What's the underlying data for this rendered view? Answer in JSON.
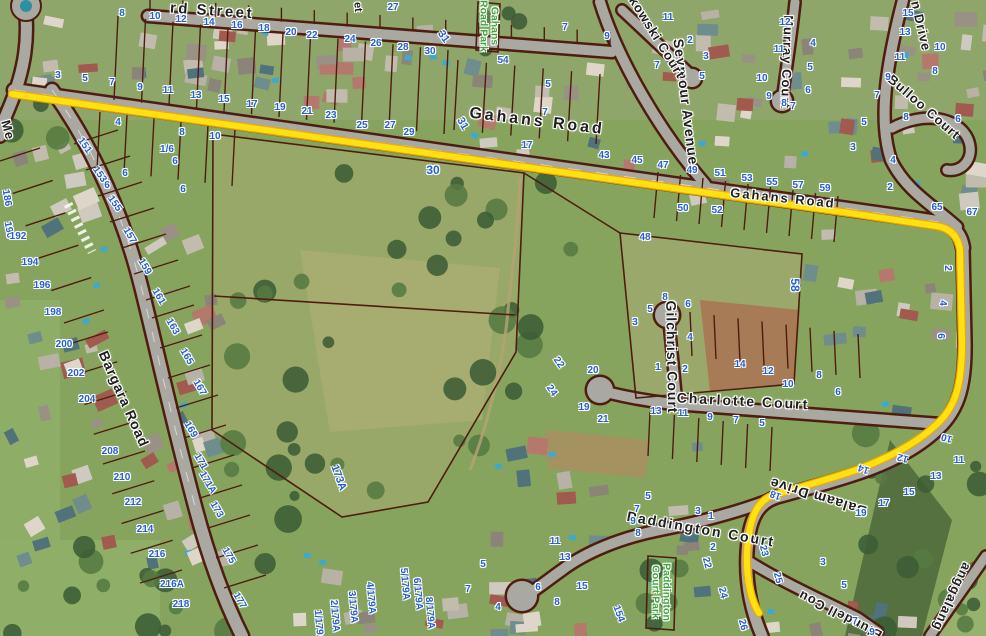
{
  "map": {
    "colors": {
      "route_highlight": "#ffe011",
      "route_highlight_edge": "#eda903",
      "cadastral_boundary": "#4f1d10",
      "lot_number_text": "#2660cf",
      "street_label_text": "#1f1f1f",
      "park_label_text": "#3ea43d",
      "road_surface": "#a9a9a1",
      "grass": "#86a45e"
    },
    "street_labels": [
      {
        "text": "rd Street",
        "x": 212,
        "y": 11,
        "rot": 4,
        "size": 15,
        "sp": 2.5
      },
      {
        "text": "Gahans Road",
        "x": 537,
        "y": 122,
        "rot": 7,
        "size": 16,
        "sp": 3
      },
      {
        "text": "Gahans Road",
        "x": 783,
        "y": 198,
        "rot": 6,
        "size": 13,
        "sp": 2
      },
      {
        "text": "Seymour Avenue",
        "x": 686,
        "y": 102,
        "rot": 83,
        "size": 14,
        "sp": 1
      },
      {
        "text": "ckowski Court",
        "x": 655,
        "y": 34,
        "rot": 58,
        "size": 13,
        "sp": 1
      },
      {
        "text": "Murray Court",
        "x": 787,
        "y": 62,
        "rot": 92,
        "size": 13,
        "sp": 1
      },
      {
        "text": "n Drive",
        "x": 921,
        "y": 26,
        "rot": 77,
        "size": 13,
        "sp": 1
      },
      {
        "text": "Bulloo Court",
        "x": 924,
        "y": 107,
        "rot": 41,
        "size": 13,
        "sp": 1
      },
      {
        "text": "Gilchrist Court",
        "x": 672,
        "y": 357,
        "rot": 89,
        "size": 14,
        "sp": 1
      },
      {
        "text": "Charlotte Court",
        "x": 743,
        "y": 401,
        "rot": 3,
        "size": 14,
        "sp": 2
      },
      {
        "text": "Paddington Court",
        "x": 701,
        "y": 529,
        "rot": 10,
        "size": 14,
        "sp": 2
      },
      {
        "text": "Balaam Drive",
        "x": 818,
        "y": 497,
        "rot": 197,
        "size": 14,
        "sp": 1
      },
      {
        "text": "Blundell Cou",
        "x": 840,
        "y": 615,
        "rot": 207,
        "size": 13,
        "sp": 1
      },
      {
        "text": "anggalang",
        "x": 952,
        "y": 597,
        "rot": 115,
        "size": 13,
        "sp": 1
      },
      {
        "text": "Bargara Road",
        "x": 124,
        "y": 399,
        "rot": 66,
        "size": 14,
        "sp": 1
      },
      {
        "text": "Me",
        "x": 8,
        "y": 130,
        "rot": 75,
        "size": 13,
        "sp": 1
      },
      {
        "text": "et",
        "x": 357,
        "y": 7,
        "rot": 85,
        "size": 11,
        "sp": 0
      }
    ],
    "park_labels": [
      {
        "text": "Gahans\nRoad Park",
        "x": 489,
        "y": 26,
        "rot": 90
      },
      {
        "text": "Paddington\nCourt Park",
        "x": 661,
        "y": 592,
        "rot": 90
      }
    ],
    "lot_labels": [
      {
        "t": "8",
        "x": 122,
        "y": 14
      },
      {
        "t": "10",
        "x": 155,
        "y": 17
      },
      {
        "t": "12",
        "x": 181,
        "y": 20
      },
      {
        "t": "14",
        "x": 209,
        "y": 23
      },
      {
        "t": "16",
        "x": 237,
        "y": 26
      },
      {
        "t": "18",
        "x": 264,
        "y": 29
      },
      {
        "t": "20",
        "x": 291,
        "y": 33
      },
      {
        "t": "22",
        "x": 312,
        "y": 36
      },
      {
        "t": "24",
        "x": 350,
        "y": 40
      },
      {
        "t": "26",
        "x": 376,
        "y": 44
      },
      {
        "t": "28",
        "x": 403,
        "y": 48
      },
      {
        "t": "30",
        "x": 430,
        "y": 52
      },
      {
        "t": "27",
        "x": 393,
        "y": 8
      },
      {
        "t": "31",
        "x": 443,
        "y": 37,
        "r": 55,
        "s": 11
      },
      {
        "t": "31",
        "x": 462,
        "y": 124,
        "r": 60,
        "s": 11
      },
      {
        "t": "3",
        "x": 58,
        "y": 76
      },
      {
        "t": "5",
        "x": 85,
        "y": 79
      },
      {
        "t": "7",
        "x": 112,
        "y": 83
      },
      {
        "t": "9",
        "x": 140,
        "y": 88
      },
      {
        "t": "11",
        "x": 168,
        "y": 91
      },
      {
        "t": "13",
        "x": 196,
        "y": 96
      },
      {
        "t": "15",
        "x": 224,
        "y": 100
      },
      {
        "t": "17",
        "x": 252,
        "y": 105
      },
      {
        "t": "19",
        "x": 280,
        "y": 108
      },
      {
        "t": "21",
        "x": 307,
        "y": 112
      },
      {
        "t": "23",
        "x": 331,
        "y": 116
      },
      {
        "t": "25",
        "x": 362,
        "y": 126
      },
      {
        "t": "27",
        "x": 390,
        "y": 126
      },
      {
        "t": "29",
        "x": 409,
        "y": 133
      },
      {
        "t": "54",
        "x": 503,
        "y": 61
      },
      {
        "t": "5",
        "x": 548,
        "y": 85
      },
      {
        "t": "7",
        "x": 545,
        "y": 113
      },
      {
        "t": "17",
        "x": 527,
        "y": 146
      },
      {
        "t": "7",
        "x": 565,
        "y": 28
      },
      {
        "t": "9",
        "x": 607,
        "y": 37
      },
      {
        "t": "11",
        "x": 668,
        "y": 18
      },
      {
        "t": "2",
        "x": 690,
        "y": 41
      },
      {
        "t": "3",
        "x": 706,
        "y": 57
      },
      {
        "t": "5",
        "x": 702,
        "y": 77
      },
      {
        "t": "7",
        "x": 657,
        "y": 66
      },
      {
        "t": "43",
        "x": 604,
        "y": 156
      },
      {
        "t": "45",
        "x": 637,
        "y": 161
      },
      {
        "t": "12",
        "x": 785,
        "y": 23
      },
      {
        "t": "11",
        "x": 779,
        "y": 50
      },
      {
        "t": "10",
        "x": 762,
        "y": 79
      },
      {
        "t": "9",
        "x": 769,
        "y": 97
      },
      {
        "t": "8",
        "x": 784,
        "y": 104
      },
      {
        "t": "7",
        "x": 793,
        "y": 107
      },
      {
        "t": "4",
        "x": 813,
        "y": 44
      },
      {
        "t": "5",
        "x": 810,
        "y": 68
      },
      {
        "t": "6",
        "x": 808,
        "y": 91
      },
      {
        "t": "15",
        "x": 908,
        "y": 14
      },
      {
        "t": "13",
        "x": 905,
        "y": 33
      },
      {
        "t": "11",
        "x": 900,
        "y": 58
      },
      {
        "t": "9",
        "x": 888,
        "y": 78
      },
      {
        "t": "7",
        "x": 877,
        "y": 96
      },
      {
        "t": "5",
        "x": 864,
        "y": 123
      },
      {
        "t": "3",
        "x": 853,
        "y": 148
      },
      {
        "t": "10",
        "x": 940,
        "y": 48
      },
      {
        "t": "8",
        "x": 935,
        "y": 72
      },
      {
        "t": "8",
        "x": 906,
        "y": 118
      },
      {
        "t": "6",
        "x": 958,
        "y": 120
      },
      {
        "t": "4",
        "x": 893,
        "y": 161
      },
      {
        "t": "2",
        "x": 890,
        "y": 188
      },
      {
        "t": "47",
        "x": 663,
        "y": 166
      },
      {
        "t": "49",
        "x": 692,
        "y": 171
      },
      {
        "t": "51",
        "x": 720,
        "y": 174
      },
      {
        "t": "53",
        "x": 747,
        "y": 179
      },
      {
        "t": "55",
        "x": 772,
        "y": 183
      },
      {
        "t": "57",
        "x": 798,
        "y": 186
      },
      {
        "t": "59",
        "x": 825,
        "y": 189
      },
      {
        "t": "50",
        "x": 683,
        "y": 209
      },
      {
        "t": "52",
        "x": 717,
        "y": 211
      },
      {
        "t": "65",
        "x": 937,
        "y": 208
      },
      {
        "t": "67",
        "x": 972,
        "y": 213
      },
      {
        "t": "30",
        "x": 433,
        "y": 170,
        "s": 12
      },
      {
        "t": "58",
        "x": 795,
        "y": 285,
        "r": 90,
        "s": 12
      },
      {
        "t": "2",
        "x": 947,
        "y": 268,
        "r": 90
      },
      {
        "t": "4",
        "x": 942,
        "y": 303,
        "r": 90
      },
      {
        "t": "6",
        "x": 940,
        "y": 336,
        "r": 90
      },
      {
        "t": "4",
        "x": 118,
        "y": 123
      },
      {
        "t": "8",
        "x": 182,
        "y": 133
      },
      {
        "t": "10",
        "x": 215,
        "y": 137
      },
      {
        "t": "1/6",
        "x": 167,
        "y": 150
      },
      {
        "t": "6",
        "x": 175,
        "y": 162
      },
      {
        "t": "6",
        "x": 125,
        "y": 174
      },
      {
        "t": "6",
        "x": 107,
        "y": 186
      },
      {
        "t": "6",
        "x": 183,
        "y": 190
      },
      {
        "t": "151",
        "x": 84,
        "y": 146,
        "r": 55
      },
      {
        "t": "153",
        "x": 99,
        "y": 175,
        "r": 55
      },
      {
        "t": "155",
        "x": 114,
        "y": 204,
        "r": 55
      },
      {
        "t": "157",
        "x": 129,
        "y": 236,
        "r": 60
      },
      {
        "t": "159",
        "x": 144,
        "y": 267,
        "r": 60
      },
      {
        "t": "161",
        "x": 158,
        "y": 297,
        "r": 60
      },
      {
        "t": "163",
        "x": 172,
        "y": 327,
        "r": 60
      },
      {
        "t": "165",
        "x": 186,
        "y": 357,
        "r": 60
      },
      {
        "t": "167",
        "x": 199,
        "y": 388,
        "r": 60
      },
      {
        "t": "169",
        "x": 190,
        "y": 430,
        "r": 60
      },
      {
        "t": "171",
        "x": 200,
        "y": 462,
        "r": 60
      },
      {
        "t": "171A",
        "x": 207,
        "y": 483,
        "r": 60
      },
      {
        "t": "173",
        "x": 216,
        "y": 510,
        "r": 60
      },
      {
        "t": "175",
        "x": 228,
        "y": 556,
        "r": 60
      },
      {
        "t": "177",
        "x": 239,
        "y": 601,
        "r": 60
      },
      {
        "t": "173A",
        "x": 338,
        "y": 478,
        "r": 70,
        "s": 11
      },
      {
        "t": "186",
        "x": 6,
        "y": 198,
        "r": 80
      },
      {
        "t": "190",
        "x": 8,
        "y": 230,
        "r": 80
      },
      {
        "t": "192",
        "x": 18,
        "y": 237
      },
      {
        "t": "194",
        "x": 30,
        "y": 263
      },
      {
        "t": "196",
        "x": 42,
        "y": 286
      },
      {
        "t": "198",
        "x": 53,
        "y": 313
      },
      {
        "t": "200",
        "x": 64,
        "y": 345
      },
      {
        "t": "202",
        "x": 76,
        "y": 374
      },
      {
        "t": "204",
        "x": 87,
        "y": 400
      },
      {
        "t": "208",
        "x": 110,
        "y": 452
      },
      {
        "t": "210",
        "x": 122,
        "y": 478
      },
      {
        "t": "212",
        "x": 133,
        "y": 503
      },
      {
        "t": "214",
        "x": 145,
        "y": 530
      },
      {
        "t": "216",
        "x": 157,
        "y": 555
      },
      {
        "t": "216A",
        "x": 172,
        "y": 585
      },
      {
        "t": "218",
        "x": 181,
        "y": 605
      },
      {
        "t": "48",
        "x": 645,
        "y": 238
      },
      {
        "t": "8",
        "x": 665,
        "y": 298
      },
      {
        "t": "5",
        "x": 650,
        "y": 310
      },
      {
        "t": "3",
        "x": 635,
        "y": 323
      },
      {
        "t": "1",
        "x": 658,
        "y": 368
      },
      {
        "t": "6",
        "x": 688,
        "y": 305
      },
      {
        "t": "4",
        "x": 690,
        "y": 338
      },
      {
        "t": "2",
        "x": 685,
        "y": 370
      },
      {
        "t": "14",
        "x": 740,
        "y": 365
      },
      {
        "t": "12",
        "x": 768,
        "y": 372
      },
      {
        "t": "10",
        "x": 788,
        "y": 385
      },
      {
        "t": "13",
        "x": 656,
        "y": 412
      },
      {
        "t": "11",
        "x": 683,
        "y": 414
      },
      {
        "t": "9",
        "x": 710,
        "y": 418
      },
      {
        "t": "7",
        "x": 736,
        "y": 421
      },
      {
        "t": "5",
        "x": 762,
        "y": 424
      },
      {
        "t": "8",
        "x": 819,
        "y": 376
      },
      {
        "t": "6",
        "x": 838,
        "y": 393
      },
      {
        "t": "22",
        "x": 558,
        "y": 363,
        "r": 55
      },
      {
        "t": "24",
        "x": 551,
        "y": 391,
        "r": 55
      },
      {
        "t": "20",
        "x": 593,
        "y": 371
      },
      {
        "t": "19",
        "x": 584,
        "y": 408
      },
      {
        "t": "21",
        "x": 603,
        "y": 420
      },
      {
        "t": "10",
        "x": 947,
        "y": 437,
        "r": 195
      },
      {
        "t": "12",
        "x": 903,
        "y": 457,
        "r": 195
      },
      {
        "t": "14",
        "x": 864,
        "y": 468,
        "r": 200
      },
      {
        "t": "18",
        "x": 776,
        "y": 494,
        "r": 200
      },
      {
        "t": "11",
        "x": 959,
        "y": 461
      },
      {
        "t": "13",
        "x": 936,
        "y": 477
      },
      {
        "t": "15",
        "x": 909,
        "y": 493
      },
      {
        "t": "17",
        "x": 884,
        "y": 504
      },
      {
        "t": "19",
        "x": 861,
        "y": 514
      },
      {
        "t": "23",
        "x": 763,
        "y": 551,
        "r": 75
      },
      {
        "t": "22",
        "x": 706,
        "y": 563,
        "r": 75
      },
      {
        "t": "25",
        "x": 777,
        "y": 578,
        "r": 75
      },
      {
        "t": "24",
        "x": 722,
        "y": 593,
        "r": 75
      },
      {
        "t": "26",
        "x": 742,
        "y": 625,
        "r": 75
      },
      {
        "t": "1",
        "x": 711,
        "y": 517
      },
      {
        "t": "2",
        "x": 713,
        "y": 548
      },
      {
        "t": "3",
        "x": 698,
        "y": 512
      },
      {
        "t": "5",
        "x": 648,
        "y": 497
      },
      {
        "t": "7",
        "x": 637,
        "y": 510
      },
      {
        "t": "9",
        "x": 633,
        "y": 522
      },
      {
        "t": "8",
        "x": 638,
        "y": 534
      },
      {
        "t": "11",
        "x": 555,
        "y": 542
      },
      {
        "t": "13",
        "x": 565,
        "y": 558
      },
      {
        "t": "15",
        "x": 582,
        "y": 587
      },
      {
        "t": "8",
        "x": 557,
        "y": 603
      },
      {
        "t": "6",
        "x": 538,
        "y": 588
      },
      {
        "t": "4",
        "x": 498,
        "y": 608
      },
      {
        "t": "5",
        "x": 483,
        "y": 565
      },
      {
        "t": "7",
        "x": 468,
        "y": 590
      },
      {
        "t": "154",
        "x": 618,
        "y": 614,
        "r": 70
      },
      {
        "t": "1/179A",
        "x": 318,
        "y": 626,
        "r": 85
      },
      {
        "t": "2/179A",
        "x": 334,
        "y": 616,
        "r": 85
      },
      {
        "t": "3/179A",
        "x": 352,
        "y": 607,
        "r": 85
      },
      {
        "t": "4/179A",
        "x": 370,
        "y": 598,
        "r": 85
      },
      {
        "t": "5/179A",
        "x": 404,
        "y": 584,
        "r": 85
      },
      {
        "t": "6/179A",
        "x": 417,
        "y": 594,
        "r": 85
      },
      {
        "t": "8/179A",
        "x": 429,
        "y": 613,
        "r": 85
      },
      {
        "t": "5",
        "x": 844,
        "y": 586
      },
      {
        "t": "7",
        "x": 855,
        "y": 622
      },
      {
        "t": "9",
        "x": 872,
        "y": 633
      },
      {
        "t": "3",
        "x": 823,
        "y": 563
      }
    ]
  }
}
